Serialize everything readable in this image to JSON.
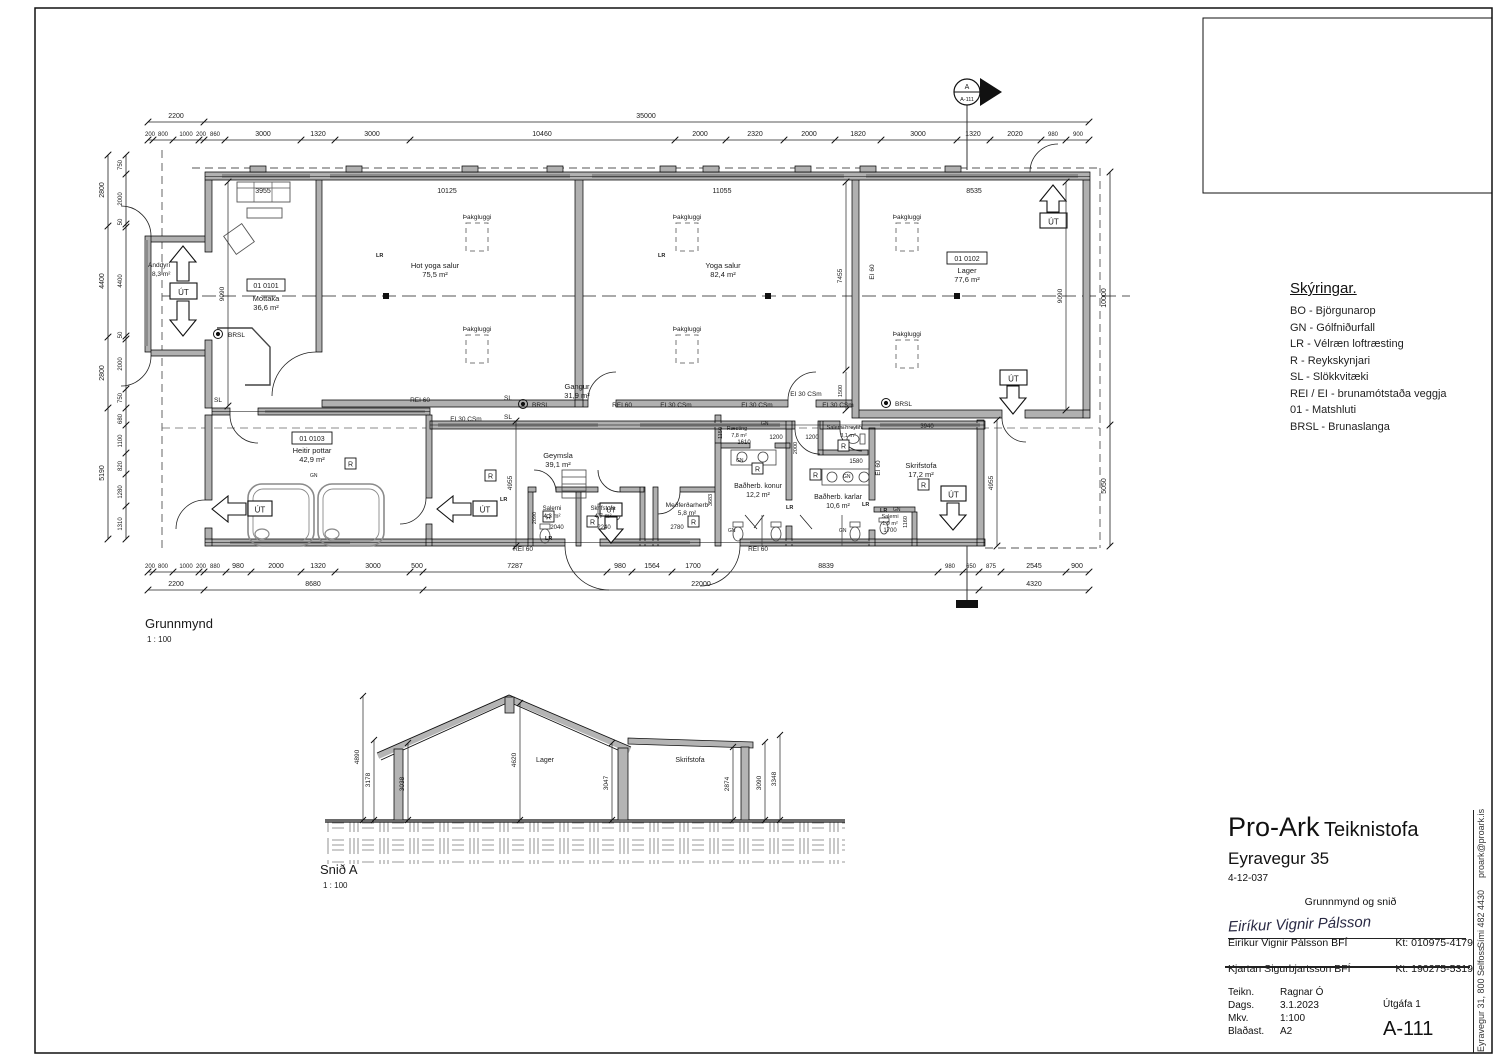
{
  "legend": {
    "title": "Skýringar.",
    "items": [
      "BO - Björgunarop",
      "GN - Gólfniðurfall",
      "LR - Vélræn loftræsting",
      "R - Reykskynjari",
      "SL - Slökkvitæki",
      "REI / EI - brunamótstaða veggja",
      "01 - Matshluti",
      "BRSL - Brunaslanga"
    ]
  },
  "marker": {
    "letter": "A",
    "sheet": "A-111"
  },
  "plan": {
    "title": "Grunnmynd",
    "scale": "1 : 100",
    "rooms": {
      "anddyri": {
        "name": "Anddyri",
        "area": "8,3 m²"
      },
      "mottaka": {
        "id": "01 0101",
        "name": "Móttaka",
        "area": "36,6 m²"
      },
      "hotyoga": {
        "name": "Hot yoga salur",
        "area": "75,5 m²"
      },
      "yoga": {
        "name": "Yoga salur",
        "area": "82,4 m²"
      },
      "lager": {
        "id": "01 0102",
        "name": "Lager",
        "area": "77,6 m²"
      },
      "gangur": {
        "name": "Gangur",
        "area": "31,9 m²"
      },
      "pottar": {
        "id": "01 0103",
        "name": "Heitir pottar",
        "area": "42,9 m²"
      },
      "geymsla": {
        "name": "Geymsla",
        "area": "39,1 m²"
      },
      "salerni1": {
        "name": "Salerni",
        "area": "4,3 m²"
      },
      "skrif1": {
        "name": "Skrifstofa",
        "area": "4,7 m²"
      },
      "medferd": {
        "name": "Meðferðarherb",
        "area": "5,8 m²"
      },
      "raesting": {
        "name": "Ræsting",
        "area": "7,8 m²"
      },
      "salerni_hr": {
        "name": "Salerni hreyfih.",
        "area": "3,1 m²"
      },
      "konur": {
        "name": "Baðherb. konur",
        "area": "12,2 m²"
      },
      "karlar": {
        "name": "Baðherb. karlar",
        "area": "10,6 m²"
      },
      "skrif2": {
        "name": "Skrifstofa",
        "area": "17,2 m²"
      },
      "salerni2": {
        "name": "Salerni",
        "area": "1,9 m²"
      }
    },
    "tags": {
      "rei60": "REI 60",
      "ei30": "EI 30 CSm",
      "ei60": "EI 60",
      "sl": "SL",
      "brsl": "BRSL",
      "lr": "LR",
      "gn": "GN",
      "r": "R",
      "ut": "ÚT",
      "skylight": "Þakgluggi"
    },
    "dims": {
      "top1": [
        "2200",
        "35000"
      ],
      "top2": [
        "200",
        "800",
        "1000",
        "200",
        "860",
        "3000",
        "1320",
        "3000",
        "10460",
        "2000",
        "2320",
        "2000",
        "1820",
        "3000",
        "1320",
        "2020",
        "980",
        "900"
      ],
      "top_inner": [
        "3955",
        "10125",
        "11055",
        "8535"
      ],
      "bottom1": [
        "200",
        "800",
        "1000",
        "200",
        "880",
        "980",
        "2000",
        "1320",
        "3000",
        "500",
        "7287",
        "980",
        "1564",
        "1700",
        "8839",
        "980",
        "650",
        "875",
        "2545",
        "900"
      ],
      "bottom2": [
        "2200",
        "8680",
        "22000",
        "4320"
      ],
      "left1": [
        "2800",
        "4400",
        "2800",
        "5190"
      ],
      "left2": [
        "750",
        "2000",
        "50",
        "4400",
        "50",
        "2000",
        "750",
        "680",
        "1100",
        "820",
        "1280",
        "1310"
      ],
      "right": [
        "10000",
        "5050"
      ],
      "inner_v": [
        "9090",
        "7455",
        "1500",
        "9090",
        "4955",
        "4955",
        "1150",
        "2090",
        "3683",
        "2000",
        "1160"
      ],
      "inner_h": [
        "3940",
        "1200",
        "1200",
        "1580",
        "1610",
        "2040",
        "2240",
        "2780",
        "1700"
      ]
    }
  },
  "section": {
    "title": "Snið A",
    "scale": "1 : 100",
    "rooms": [
      "Lager",
      "Skrifstofa"
    ],
    "dims": [
      "4890",
      "3178",
      "3038",
      "4620",
      "3047",
      "2874",
      "3090",
      "3348"
    ]
  },
  "titleblock": {
    "company": "Pro-Ark",
    "studio": "Teiknistofa",
    "project": "Eyravegur 35",
    "project_no": "4-12-037",
    "drawing_title": "Grunnmynd og snið",
    "signature": "Eiríkur Vignir Pálsson",
    "name1": "Eiríkur Vignir Pálsson BFÍ",
    "kt1": "Kt: 010975-4179",
    "name2": "Kjartan Sigurbjartsson BFÍ",
    "kt2": "Kt: 190275-5319",
    "teikn_label": "Teikn.",
    "teikn": "Ragnar Ó",
    "dags_label": "Dags.",
    "dags": "3.1.2023",
    "mkv_label": "Mkv.",
    "mkv": "1:100",
    "blad_label": "Blaðast.",
    "blad": "A2",
    "utgafa": "Útgáfa 1",
    "sheet": "A-111",
    "address": "Eyravegur 31, 800 Selfoss",
    "phone": "Sími 482 4430",
    "email": "proark@proark.is"
  }
}
